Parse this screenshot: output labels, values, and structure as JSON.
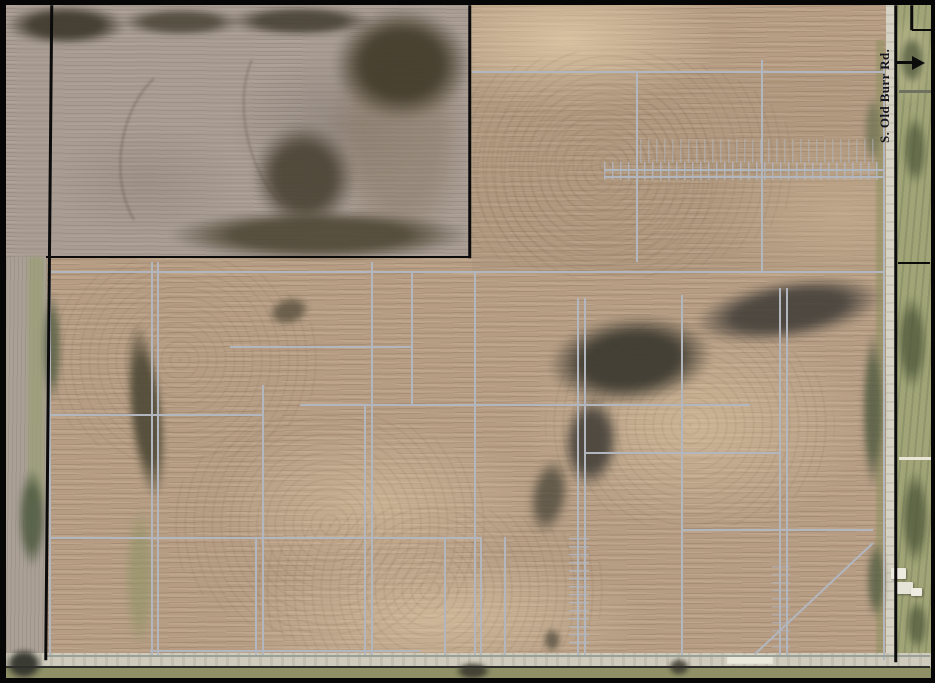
{
  "map": {
    "road_label": "S. Old Burr Rd.",
    "arrow_icon": "east-arrow",
    "description": "Aerial photo of farm parcels with drainage tile line overlay"
  },
  "palette": {
    "field_tan": "#b59c83",
    "field_gray": "#a89c93",
    "tile_line": "#b2b6bf",
    "boundary_black": "#0b0b0c",
    "road_pavement": "#d6d2c4",
    "lawn_green": "#a0a476",
    "tree_dark": "#453f30"
  },
  "overlay": {
    "tile_lines": [
      {
        "x1": 50,
        "y1": 262,
        "x2": 50,
        "y2": 656
      },
      {
        "x1": 152,
        "y1": 262,
        "x2": 152,
        "y2": 656
      },
      {
        "x1": 158,
        "y1": 262,
        "x2": 158,
        "y2": 656
      },
      {
        "x1": 256,
        "y1": 537,
        "x2": 256,
        "y2": 656
      },
      {
        "x1": 263,
        "y1": 385,
        "x2": 263,
        "y2": 656
      },
      {
        "x1": 365,
        "y1": 405,
        "x2": 365,
        "y2": 656
      },
      {
        "x1": 372,
        "y1": 262,
        "x2": 372,
        "y2": 656
      },
      {
        "x1": 412,
        "y1": 272,
        "x2": 412,
        "y2": 405
      },
      {
        "x1": 445,
        "y1": 537,
        "x2": 445,
        "y2": 656
      },
      {
        "x1": 475,
        "y1": 272,
        "x2": 475,
        "y2": 656
      },
      {
        "x1": 481,
        "y1": 537,
        "x2": 481,
        "y2": 656
      },
      {
        "x1": 505,
        "y1": 537,
        "x2": 505,
        "y2": 656
      },
      {
        "x1": 578,
        "y1": 298,
        "x2": 578,
        "y2": 656
      },
      {
        "x1": 585,
        "y1": 298,
        "x2": 585,
        "y2": 656
      },
      {
        "x1": 637,
        "y1": 72,
        "x2": 637,
        "y2": 262
      },
      {
        "x1": 682,
        "y1": 295,
        "x2": 682,
        "y2": 656
      },
      {
        "x1": 762,
        "y1": 60,
        "x2": 762,
        "y2": 273
      },
      {
        "x1": 780,
        "y1": 288,
        "x2": 780,
        "y2": 656
      },
      {
        "x1": 787,
        "y1": 288,
        "x2": 787,
        "y2": 656
      },
      {
        "x1": 884,
        "y1": 60,
        "x2": 884,
        "y2": 660
      },
      {
        "x1": 472,
        "y1": 72,
        "x2": 884,
        "y2": 72
      },
      {
        "x1": 604,
        "y1": 170,
        "x2": 884,
        "y2": 170
      },
      {
        "x1": 604,
        "y1": 177,
        "x2": 884,
        "y2": 177
      },
      {
        "x1": 50,
        "y1": 272,
        "x2": 884,
        "y2": 272
      },
      {
        "x1": 230,
        "y1": 347,
        "x2": 412,
        "y2": 347
      },
      {
        "x1": 300,
        "y1": 405,
        "x2": 750,
        "y2": 405
      },
      {
        "x1": 50,
        "y1": 415,
        "x2": 263,
        "y2": 415
      },
      {
        "x1": 585,
        "y1": 453,
        "x2": 780,
        "y2": 453
      },
      {
        "x1": 682,
        "y1": 530,
        "x2": 873,
        "y2": 530
      },
      {
        "x1": 50,
        "y1": 538,
        "x2": 481,
        "y2": 538
      },
      {
        "x1": 150,
        "y1": 651,
        "x2": 420,
        "y2": 651
      },
      {
        "x1": 45,
        "y1": 656,
        "x2": 930,
        "y2": 656,
        "c": "#9aa096"
      },
      {
        "x1": 873,
        "y1": 543,
        "x2": 755,
        "y2": 654
      },
      {
        "x1": 899,
        "y1": 91,
        "x2": 933,
        "y2": 91,
        "w": 3,
        "c": "#70725f"
      },
      {
        "x1": 899,
        "y1": 458,
        "x2": 933,
        "y2": 458,
        "w": 3,
        "c": "#e9e6d8"
      }
    ],
    "tick_strips": [
      {
        "x": 604,
        "y": 162,
        "w": 280,
        "h": 18,
        "axis": "x",
        "o": 0.9
      },
      {
        "x": 640,
        "y": 139,
        "w": 240,
        "h": 24,
        "axis": "x",
        "o": 0.55
      },
      {
        "x": 569,
        "y": 538,
        "w": 20,
        "h": 112,
        "axis": "y",
        "o": 0.9
      },
      {
        "x": 772,
        "y": 566,
        "w": 18,
        "h": 86,
        "axis": "y",
        "o": 0.6
      }
    ],
    "black_lines": [
      {
        "x1": 52,
        "y1": 5,
        "x2": 46,
        "y2": 660,
        "w": 2.5
      },
      {
        "x1": 470,
        "y1": 5,
        "x2": 470,
        "y2": 258,
        "w": 2.5
      },
      {
        "x1": 46,
        "y1": 257,
        "x2": 470,
        "y2": 257,
        "w": 2.5
      },
      {
        "x1": 896,
        "y1": 5,
        "x2": 896,
        "y2": 662,
        "w": 2.5
      },
      {
        "x1": 898,
        "y1": 263,
        "x2": 930,
        "y2": 263,
        "w": 2
      },
      {
        "x1": 912,
        "y1": 5,
        "x2": 912,
        "y2": 30,
        "w": 2.5
      },
      {
        "x1": 912,
        "y1": 30,
        "x2": 933,
        "y2": 30,
        "w": 2.5
      },
      {
        "x1": 5,
        "y1": 667,
        "x2": 930,
        "y2": 667,
        "w": 2,
        "c": "#2e2e2a"
      }
    ]
  },
  "features": {
    "trees": [
      {
        "x": 330,
        "y": 8,
        "w": 140,
        "h": 250,
        "c": "#8a7a66",
        "o": 0.5,
        "b": 2
      },
      {
        "x": 5,
        "y": 5,
        "w": 122,
        "h": 40,
        "c": "#423c2f",
        "o": 0.95,
        "b": 3
      },
      {
        "x": 120,
        "y": 8,
        "w": 122,
        "h": 28,
        "c": "#4a4436",
        "o": 0.85,
        "b": 3
      },
      {
        "x": 228,
        "y": 6,
        "w": 145,
        "h": 30,
        "c": "#423c2f",
        "o": 0.85,
        "b": 3
      },
      {
        "x": 333,
        "y": 8,
        "w": 138,
        "h": 112,
        "c": "#453e2d",
        "o": 0.95,
        "b": 4
      },
      {
        "x": 253,
        "y": 124,
        "w": 102,
        "h": 106,
        "c": "#4a4334",
        "o": 0.9,
        "b": 4,
        "r": -18
      },
      {
        "x": 168,
        "y": 210,
        "w": 302,
        "h": 50,
        "c": "#4f4836",
        "o": 0.9,
        "b": 3
      },
      {
        "x": 128,
        "y": 322,
        "w": 36,
        "h": 178,
        "c": "#4e4936",
        "o": 0.9,
        "b": 3,
        "r": -6
      },
      {
        "x": 268,
        "y": 297,
        "w": 42,
        "h": 28,
        "c": "#5a5240",
        "o": 0.8,
        "b": 3,
        "r": -15
      },
      {
        "x": 548,
        "y": 316,
        "w": 165,
        "h": 88,
        "c": "#3e3b31",
        "o": 0.95,
        "b": 4,
        "r": -6
      },
      {
        "x": 693,
        "y": 280,
        "w": 192,
        "h": 60,
        "c": "#44403a",
        "o": 0.9,
        "b": 4,
        "r": -9
      },
      {
        "x": 563,
        "y": 396,
        "w": 56,
        "h": 92,
        "c": "#45413a",
        "o": 0.9,
        "b": 4,
        "r": 4
      },
      {
        "x": 530,
        "y": 458,
        "w": 38,
        "h": 76,
        "c": "#4a4639",
        "o": 0.75,
        "b": 4,
        "r": 10
      },
      {
        "x": 455,
        "y": 662,
        "w": 36,
        "h": 18,
        "c": "#3c3a2f",
        "o": 0.9,
        "b": 2
      },
      {
        "x": 668,
        "y": 658,
        "w": 22,
        "h": 18,
        "c": "#3c3a2f",
        "o": 0.85,
        "b": 2
      },
      {
        "x": 543,
        "y": 628,
        "w": 18,
        "h": 24,
        "c": "#4c483a",
        "o": 0.7,
        "b": 3
      },
      {
        "x": 42,
        "y": 292,
        "w": 20,
        "h": 110,
        "c": "#566046",
        "o": 0.8,
        "b": 3
      },
      {
        "x": 18,
        "y": 468,
        "w": 28,
        "h": 100,
        "c": "#4e5a40",
        "o": 0.85,
        "b": 3
      },
      {
        "x": 5,
        "y": 648,
        "w": 38,
        "h": 32,
        "c": "#33342c",
        "o": 0.95,
        "b": 2
      },
      {
        "x": 862,
        "y": 330,
        "w": 22,
        "h": 160,
        "c": "#4f5a40",
        "o": 0.8,
        "b": 3
      },
      {
        "x": 864,
        "y": 95,
        "w": 18,
        "h": 70,
        "c": "#6a7050",
        "o": 0.7,
        "b": 3
      },
      {
        "x": 866,
        "y": 540,
        "w": 20,
        "h": 80,
        "c": "#515c42",
        "o": 0.75,
        "b": 3
      },
      {
        "x": 899,
        "y": 35,
        "w": 26,
        "h": 50,
        "c": "#4c5539",
        "o": 0.75,
        "b": 3
      },
      {
        "x": 903,
        "y": 115,
        "w": 24,
        "h": 70,
        "c": "#4c5539",
        "o": 0.7,
        "b": 3
      },
      {
        "x": 897,
        "y": 295,
        "w": 30,
        "h": 95,
        "c": "#4c5539",
        "o": 0.75,
        "b": 3
      },
      {
        "x": 901,
        "y": 470,
        "w": 28,
        "h": 95,
        "c": "#4c5539",
        "o": 0.75,
        "b": 3
      },
      {
        "x": 906,
        "y": 600,
        "w": 22,
        "h": 50,
        "c": "#4c5539",
        "o": 0.7,
        "b": 3
      },
      {
        "x": 125,
        "y": 505,
        "w": 30,
        "h": 145,
        "c": "#8f9465",
        "o": 0.6,
        "b": 4
      }
    ],
    "buildings": [
      {
        "x": 891,
        "y": 568,
        "w": 15,
        "h": 11,
        "c": "#edeae0"
      },
      {
        "x": 896,
        "y": 582,
        "w": 17,
        "h": 12,
        "c": "#e6e3d8"
      },
      {
        "x": 911,
        "y": 588,
        "w": 11,
        "h": 8,
        "c": "#efece2"
      }
    ],
    "curves": [
      {
        "x": 120,
        "y": 60,
        "w": 130,
        "h": 190,
        "r": 8,
        "c": "rgba(88,76,66,.38)"
      },
      {
        "x": 245,
        "y": 30,
        "w": 110,
        "h": 190,
        "r": -12,
        "c": "rgba(88,76,66,.34)"
      }
    ]
  }
}
